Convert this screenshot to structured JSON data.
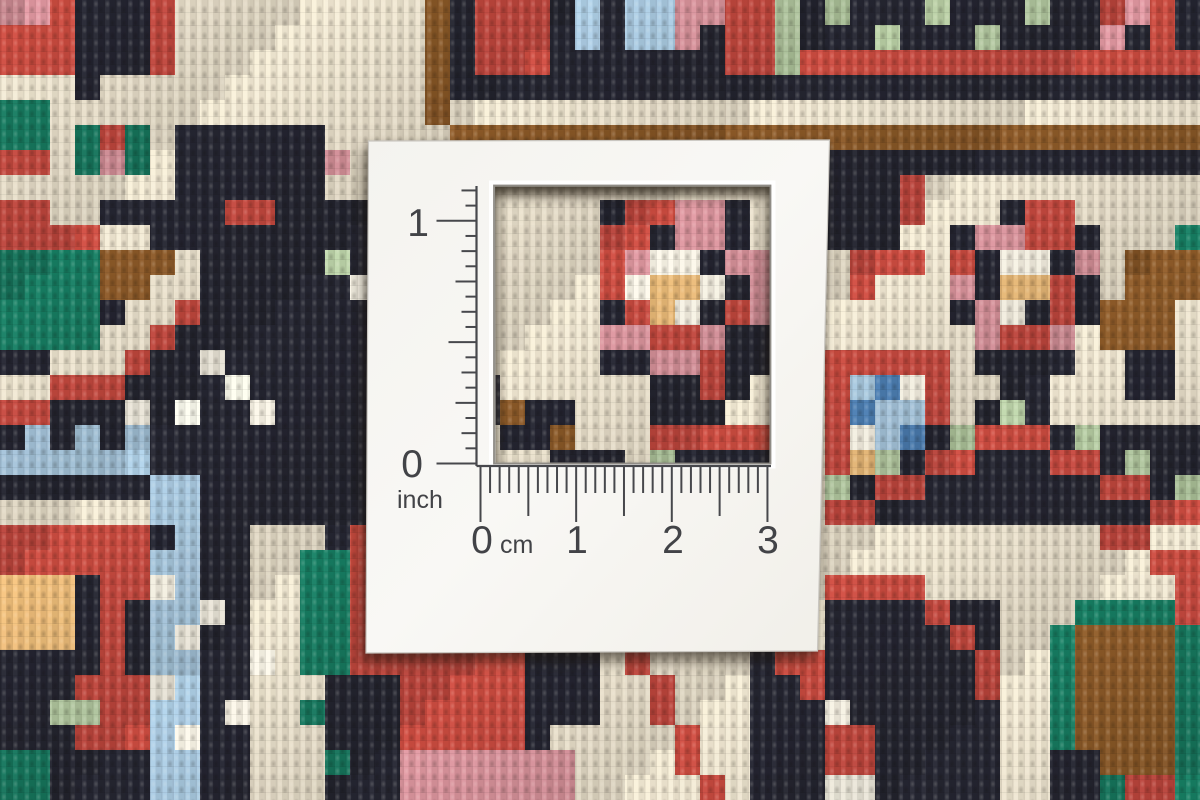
{
  "card": {
    "inch": {
      "max": "1",
      "min": "0",
      "unit": "inch"
    },
    "cm": {
      "labels": [
        "0",
        "1",
        "2",
        "3"
      ],
      "unit": "cm"
    },
    "ink_color": "#47484c",
    "face_color": "#f7f6f2"
  },
  "rug": {
    "grid": {
      "cols": 48,
      "rows": 32,
      "cell": 25
    },
    "palette": {
      "K": "#232430",
      "R": "#c5483e",
      "C": "#ebe2cd",
      "W": "#f7f2e4",
      "P": "#d8929b",
      "O": "#e9b977",
      "G": "#15795f",
      "g": "#b5cba2",
      "B": "#a7c7de",
      "b": "#4b7eb3",
      "N": "#8a5827"
    },
    "base": "K",
    "ops": [
      [
        "R",
        0,
        0,
        2,
        2
      ],
      [
        "P",
        0,
        0,
        1,
        0
      ],
      [
        "C",
        0,
        3,
        2,
        3
      ],
      [
        "G",
        0,
        4,
        1,
        5
      ],
      [
        "R",
        0,
        6,
        2,
        7
      ],
      [
        "C",
        7,
        0,
        16,
        4
      ],
      [
        "R",
        6,
        0,
        6,
        2
      ],
      [
        "C",
        4,
        3,
        6,
        4
      ],
      [
        "C",
        2,
        4,
        6,
        7
      ],
      [
        "G",
        3,
        5,
        5,
        6
      ],
      [
        "R",
        4,
        5,
        4,
        5
      ],
      [
        "P",
        4,
        6,
        4,
        6
      ],
      [
        "C",
        0,
        7,
        1,
        7
      ],
      [
        "C",
        2,
        8,
        3,
        8
      ],
      [
        "C",
        4,
        9,
        5,
        9
      ],
      [
        "R",
        0,
        8,
        1,
        9
      ],
      [
        "R",
        2,
        9,
        3,
        9
      ],
      [
        "N",
        4,
        10,
        6,
        11
      ],
      [
        "G",
        0,
        10,
        3,
        13
      ],
      [
        "C",
        7,
        10,
        7,
        11
      ],
      [
        "C",
        6,
        11,
        6,
        12
      ],
      [
        "C",
        5,
        12,
        5,
        13
      ],
      [
        "C",
        4,
        13,
        4,
        14
      ],
      [
        "C",
        2,
        14,
        3,
        14
      ],
      [
        "C",
        0,
        15,
        1,
        15
      ],
      [
        "R",
        7,
        12,
        7,
        12
      ],
      [
        "R",
        6,
        13,
        6,
        13
      ],
      [
        "R",
        5,
        14,
        5,
        14
      ],
      [
        "R",
        4,
        15,
        4,
        15
      ],
      [
        "R",
        2,
        15,
        3,
        15
      ],
      [
        "R",
        0,
        16,
        1,
        16
      ],
      [
        "W",
        8,
        14,
        8,
        14
      ],
      [
        "W",
        9,
        15,
        9,
        15
      ],
      [
        "W",
        10,
        16,
        10,
        16
      ],
      [
        "W",
        7,
        16,
        7,
        16
      ],
      [
        "W",
        5,
        16,
        5,
        16
      ],
      [
        "R",
        9,
        8,
        10,
        8
      ],
      [
        "g",
        13,
        10,
        13,
        10
      ],
      [
        "W",
        14,
        11,
        14,
        11
      ],
      [
        "B",
        0,
        18,
        5,
        18
      ],
      [
        "B",
        1,
        17,
        1,
        17
      ],
      [
        "B",
        3,
        17,
        3,
        17
      ],
      [
        "B",
        5,
        17,
        5,
        17
      ],
      [
        "B",
        6,
        19,
        7,
        20
      ],
      [
        "B",
        7,
        21,
        7,
        21
      ],
      [
        "B",
        6,
        22,
        7,
        31
      ],
      [
        "W",
        6,
        23,
        6,
        23
      ],
      [
        "W",
        7,
        25,
        7,
        25
      ],
      [
        "W",
        6,
        27,
        6,
        27
      ],
      [
        "W",
        7,
        29,
        7,
        29
      ],
      [
        "C",
        0,
        20,
        5,
        20
      ],
      [
        "R",
        0,
        21,
        5,
        23
      ],
      [
        "R",
        3,
        24,
        4,
        26
      ],
      [
        "O",
        0,
        23,
        2,
        25
      ],
      [
        "K",
        3,
        23,
        3,
        26
      ],
      [
        "K",
        0,
        26,
        2,
        26
      ],
      [
        "R",
        3,
        27,
        5,
        29
      ],
      [
        "g",
        2,
        28,
        3,
        28
      ],
      [
        "G",
        0,
        30,
        1,
        31
      ],
      [
        "W",
        8,
        24,
        8,
        24
      ],
      [
        "W",
        9,
        28,
        9,
        28
      ],
      [
        "C",
        10,
        21,
        12,
        31
      ],
      [
        "G",
        12,
        22,
        13,
        26
      ],
      [
        "G",
        12,
        28,
        12,
        28
      ],
      [
        "G",
        13,
        30,
        13,
        30
      ],
      [
        "W",
        10,
        26,
        10,
        26
      ],
      [
        "R",
        14,
        21,
        15,
        26
      ],
      [
        "C",
        15,
        5,
        32,
        26
      ],
      [
        "C",
        13,
        5,
        14,
        7
      ],
      [
        "P",
        13,
        6,
        13,
        6
      ],
      [
        "K",
        19,
        15,
        19,
        16
      ],
      [
        "K",
        20,
        16,
        22,
        17
      ],
      [
        "K",
        22,
        18,
        24,
        18
      ],
      [
        "N",
        20,
        16,
        20,
        16
      ],
      [
        "N",
        22,
        17,
        22,
        17
      ],
      [
        "R",
        26,
        17,
        30,
        17
      ],
      [
        "g",
        26,
        18,
        26,
        18
      ],
      [
        "K",
        27,
        18,
        30,
        18
      ],
      [
        "K",
        24,
        8,
        30,
        16
      ],
      [
        "C",
        30,
        8,
        30,
        9
      ],
      [
        "C",
        24,
        15,
        25,
        16
      ],
      [
        "C",
        29,
        16,
        30,
        16
      ],
      [
        "C",
        30,
        15,
        30,
        15
      ],
      [
        "R",
        25,
        8,
        26,
        8
      ],
      [
        "P",
        27,
        8,
        28,
        8
      ],
      [
        "R",
        24,
        9,
        25,
        9
      ],
      [
        "P",
        27,
        9,
        28,
        9
      ],
      [
        "R",
        24,
        10,
        24,
        10
      ],
      [
        "P",
        25,
        10,
        25,
        10
      ],
      [
        "W",
        26,
        10,
        27,
        10
      ],
      [
        "P",
        29,
        10,
        30,
        10
      ],
      [
        "W",
        25,
        11,
        25,
        11
      ],
      [
        "O",
        26,
        11,
        27,
        11
      ],
      [
        "W",
        28,
        11,
        28,
        11
      ],
      [
        "P",
        30,
        11,
        30,
        12
      ],
      [
        "R",
        24,
        11,
        24,
        11
      ],
      [
        "R",
        25,
        12,
        25,
        12
      ],
      [
        "O",
        26,
        12,
        26,
        12
      ],
      [
        "W",
        27,
        12,
        27,
        12
      ],
      [
        "R",
        29,
        12,
        29,
        12
      ],
      [
        "R",
        26,
        13,
        27,
        13
      ],
      [
        "P",
        24,
        13,
        25,
        13
      ],
      [
        "P",
        28,
        13,
        28,
        13
      ],
      [
        "P",
        26,
        14,
        27,
        14
      ],
      [
        "R",
        28,
        14,
        28,
        14
      ],
      [
        "R",
        28,
        15,
        28,
        15
      ],
      [
        "N",
        17,
        0,
        17,
        4
      ],
      [
        "R",
        19,
        0,
        31,
        2
      ],
      [
        "K",
        22,
        0,
        28,
        2
      ],
      [
        "B",
        23,
        0,
        23,
        1
      ],
      [
        "B",
        25,
        0,
        26,
        1
      ],
      [
        "P",
        27,
        0,
        28,
        0
      ],
      [
        "P",
        27,
        1,
        27,
        1
      ],
      [
        "g",
        31,
        0,
        31,
        3
      ],
      [
        "K",
        19,
        3,
        31,
        3
      ],
      [
        "C",
        18,
        4,
        47,
        4
      ],
      [
        "N",
        18,
        5,
        47,
        5
      ],
      [
        "g",
        33,
        0,
        33,
        0
      ],
      [
        "g",
        35,
        1,
        35,
        1
      ],
      [
        "g",
        37,
        0,
        37,
        0
      ],
      [
        "g",
        39,
        1,
        39,
        1
      ],
      [
        "g",
        41,
        0,
        41,
        0
      ],
      [
        "R",
        44,
        0,
        46,
        1
      ],
      [
        "P",
        45,
        0,
        45,
        0
      ],
      [
        "P",
        44,
        1,
        44,
        1
      ],
      [
        "K",
        45,
        1,
        45,
        1
      ],
      [
        "R",
        32,
        2,
        47,
        2
      ],
      [
        "C",
        33,
        7,
        47,
        16
      ],
      [
        "K",
        33,
        7,
        35,
        9
      ],
      [
        "R",
        36,
        7,
        36,
        8
      ],
      [
        "R",
        34,
        10,
        36,
        10
      ],
      [
        "R",
        34,
        11,
        34,
        11
      ],
      [
        "K",
        38,
        8,
        43,
        14
      ],
      [
        "C",
        38,
        8,
        39,
        8
      ],
      [
        "C",
        43,
        8,
        43,
        8
      ],
      [
        "R",
        41,
        8,
        42,
        8
      ],
      [
        "P",
        39,
        9,
        40,
        9
      ],
      [
        "R",
        41,
        9,
        42,
        9
      ],
      [
        "R",
        38,
        10,
        38,
        10
      ],
      [
        "W",
        40,
        10,
        41,
        10
      ],
      [
        "P",
        43,
        10,
        43,
        10
      ],
      [
        "O",
        40,
        11,
        41,
        11
      ],
      [
        "P",
        38,
        11,
        38,
        11
      ],
      [
        "R",
        42,
        11,
        42,
        11
      ],
      [
        "W",
        40,
        12,
        40,
        12
      ],
      [
        "P",
        39,
        12,
        39,
        12
      ],
      [
        "R",
        42,
        12,
        42,
        12
      ],
      [
        "R",
        40,
        13,
        41,
        13
      ],
      [
        "P",
        42,
        13,
        42,
        13
      ],
      [
        "P",
        39,
        13,
        39,
        13
      ],
      [
        "C",
        38,
        13,
        38,
        14
      ],
      [
        "C",
        43,
        13,
        43,
        14
      ],
      [
        "K",
        40,
        15,
        41,
        15
      ],
      [
        "R",
        33,
        14,
        37,
        18
      ],
      [
        "B",
        34,
        15,
        36,
        17
      ],
      [
        "b",
        35,
        15,
        35,
        15
      ],
      [
        "b",
        34,
        16,
        34,
        16
      ],
      [
        "b",
        36,
        17,
        36,
        17
      ],
      [
        "W",
        36,
        15,
        36,
        15
      ],
      [
        "W",
        34,
        17,
        34,
        17
      ],
      [
        "O",
        34,
        18,
        34,
        18
      ],
      [
        "G",
        47,
        9,
        47,
        10
      ],
      [
        "N",
        45,
        10,
        47,
        11
      ],
      [
        "N",
        44,
        12,
        46,
        13
      ],
      [
        "K",
        45,
        14,
        46,
        15
      ],
      [
        "K",
        33,
        19,
        34,
        19
      ],
      [
        "K",
        35,
        18,
        36,
        18
      ],
      [
        "K",
        37,
        17,
        38,
        17
      ],
      [
        "K",
        39,
        16,
        41,
        16
      ],
      [
        "K",
        42,
        17,
        43,
        17
      ],
      [
        "K",
        44,
        18,
        45,
        18
      ],
      [
        "K",
        46,
        19,
        47,
        19
      ],
      [
        "g",
        35,
        18,
        35,
        18
      ],
      [
        "g",
        38,
        17,
        38,
        17
      ],
      [
        "g",
        40,
        16,
        40,
        16
      ],
      [
        "g",
        43,
        17,
        43,
        17
      ],
      [
        "g",
        45,
        18,
        45,
        18
      ],
      [
        "g",
        47,
        19,
        47,
        19
      ],
      [
        "g",
        33,
        19,
        33,
        19
      ],
      [
        "R",
        33,
        20,
        34,
        20
      ],
      [
        "R",
        35,
        19,
        36,
        19
      ],
      [
        "R",
        37,
        18,
        38,
        18
      ],
      [
        "R",
        39,
        17,
        41,
        17
      ],
      [
        "R",
        42,
        18,
        43,
        18
      ],
      [
        "R",
        44,
        19,
        45,
        19
      ],
      [
        "R",
        46,
        20,
        47,
        20
      ],
      [
        "C",
        33,
        21,
        47,
        23
      ],
      [
        "R",
        44,
        21,
        45,
        21
      ],
      [
        "R",
        46,
        22,
        47,
        22
      ],
      [
        "K",
        33,
        24,
        39,
        31
      ],
      [
        "R",
        33,
        23,
        36,
        23
      ],
      [
        "R",
        37,
        24,
        37,
        24
      ],
      [
        "R",
        38,
        25,
        38,
        25
      ],
      [
        "R",
        39,
        26,
        39,
        27
      ],
      [
        "W",
        33,
        28,
        33,
        28
      ],
      [
        "R",
        33,
        29,
        34,
        30
      ],
      [
        "W",
        33,
        31,
        34,
        31
      ],
      [
        "C",
        40,
        24,
        41,
        31
      ],
      [
        "G",
        42,
        24,
        47,
        31
      ],
      [
        "N",
        43,
        25,
        46,
        30
      ],
      [
        "K",
        42,
        30,
        43,
        31
      ],
      [
        "R",
        47,
        23,
        47,
        24
      ],
      [
        "R",
        45,
        31,
        46,
        31
      ],
      [
        "C",
        42,
        24,
        42,
        24
      ],
      [
        "R",
        15,
        26,
        20,
        31
      ],
      [
        "K",
        21,
        26,
        23,
        27
      ],
      [
        "K",
        22,
        28,
        23,
        28
      ],
      [
        "K",
        15,
        27,
        15,
        31
      ],
      [
        "C",
        24,
        26,
        29,
        31
      ],
      [
        "C",
        22,
        29,
        23,
        31
      ],
      [
        "P",
        16,
        30,
        20,
        31
      ],
      [
        "P",
        21,
        30,
        22,
        31
      ],
      [
        "R",
        25,
        26,
        25,
        26
      ],
      [
        "R",
        26,
        27,
        26,
        28
      ],
      [
        "R",
        27,
        29,
        27,
        30
      ],
      [
        "R",
        28,
        31,
        28,
        31
      ],
      [
        "K",
        30,
        26,
        32,
        31
      ],
      [
        "R",
        31,
        26,
        32,
        26
      ],
      [
        "R",
        32,
        27,
        32,
        27
      ]
    ]
  }
}
